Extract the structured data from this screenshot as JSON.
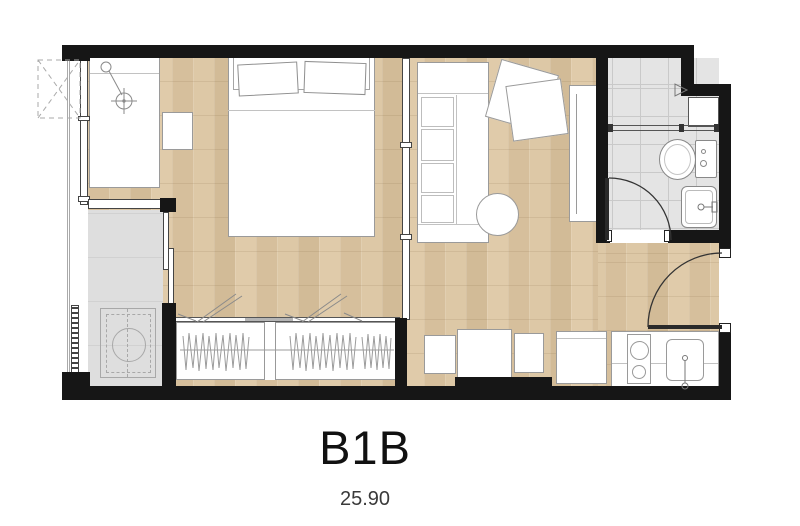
{
  "plan": {
    "unit_name": "B1B",
    "unit_area": "25.90"
  },
  "colors": {
    "wall": "#161616",
    "wood_floor": "#d8c2a0",
    "tile_floor": "#e4e4e4",
    "tile_grid": "#c9c9c9",
    "balcony_floor": "#dedede",
    "furniture_line": "#9a9a9a",
    "detail_line": "#8a8a8a",
    "door_line": "#2a2a2a",
    "text": "#111111",
    "area_text": "#3a3a3a"
  }
}
